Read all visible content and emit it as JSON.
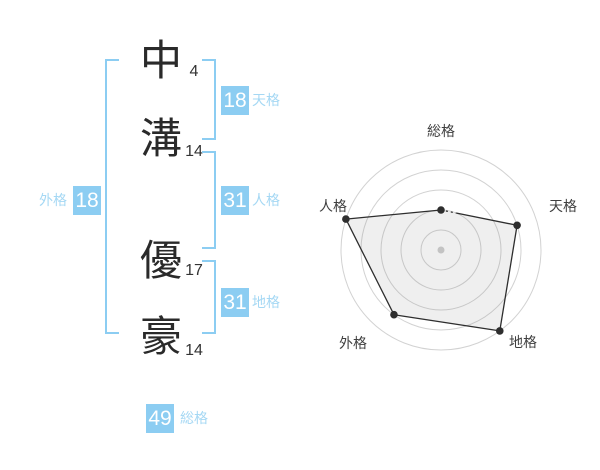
{
  "colors": {
    "accent_blue": "#8ccdf2",
    "label_blue": "#a5d8f4",
    "text_dark": "#2a2a2a",
    "number_gray": "#333333",
    "ring_gray": "#d2d2d2",
    "polygon_stroke": "#2e2e2e",
    "polygon_fill": "rgba(120,120,120,0.12)",
    "center_dot": "#c3c3c3",
    "radar_label": "#3f3f3f"
  },
  "name_diagram": {
    "characters": [
      {
        "char": "中",
        "strokes": "4"
      },
      {
        "char": "溝",
        "strokes": "14"
      },
      {
        "char": "優",
        "strokes": "17"
      },
      {
        "char": "豪",
        "strokes": "14"
      }
    ],
    "kaku": {
      "tenkaku": {
        "value": "18",
        "label": "天格"
      },
      "jinkaku": {
        "value": "31",
        "label": "人格"
      },
      "chikaku": {
        "value": "31",
        "label": "地格"
      },
      "gaikaku": {
        "value": "18",
        "label": "外格"
      },
      "soukaku": {
        "value": "49",
        "label": "総格"
      }
    }
  },
  "chart_data": {
    "type": "radar",
    "axes": [
      "総格",
      "天格",
      "地格",
      "外格",
      "人格"
    ],
    "values": [
      2,
      4,
      5,
      4,
      5
    ],
    "max": 5,
    "rings": 5,
    "start_angle_deg": 90,
    "direction": "clockwise",
    "grid": "concentric-circles",
    "legend": "none",
    "title": ""
  }
}
